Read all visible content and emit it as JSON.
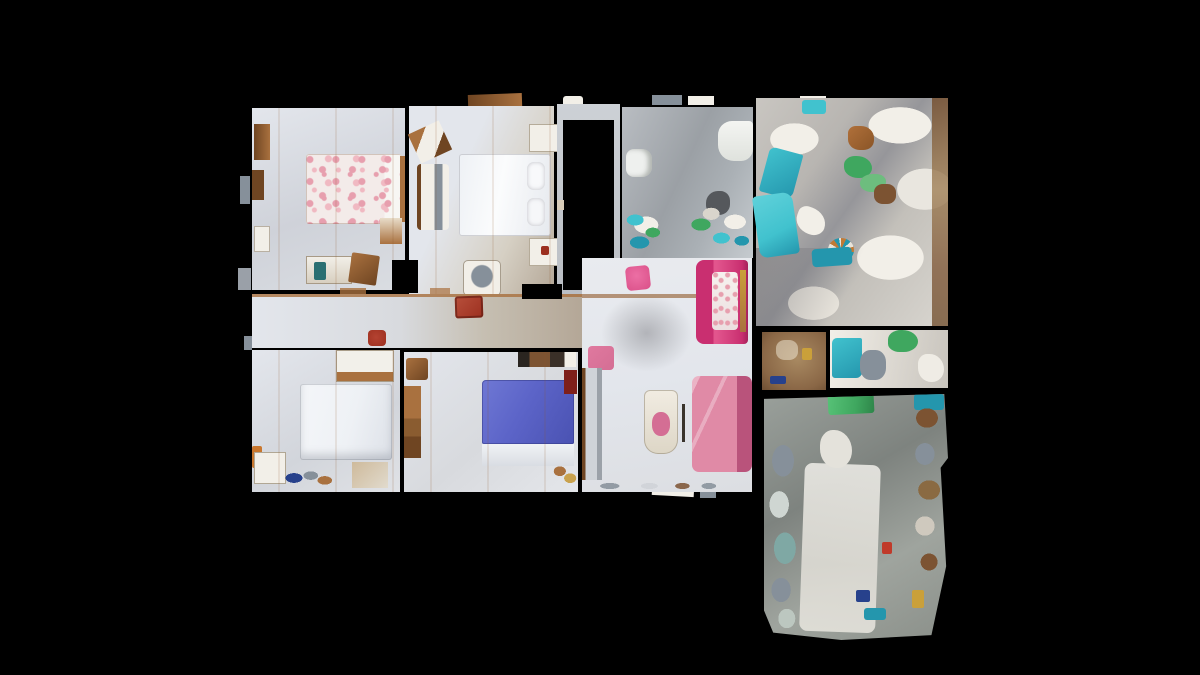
{
  "scene": {
    "type": "3d-scan-floorplan-topdown",
    "description": "Top-down dollhouse view of a 3D-scanned apartment floor plan centered on a black background",
    "background_color": "#000000",
    "visible_text": "",
    "rooms": [
      {
        "id": "bedroom-floral",
        "label": "Bedroom with floral double bed",
        "position": "top-left"
      },
      {
        "id": "bedroom-white",
        "label": "Bedroom with white double bed",
        "position": "top-center-left"
      },
      {
        "id": "stairwell",
        "label": "Stairwell void (black opening)",
        "position": "top-center"
      },
      {
        "id": "bathroom",
        "label": "Bathroom with tub and toilet",
        "position": "top-center-right"
      },
      {
        "id": "storage-top",
        "label": "Cluttered storage room with teal objects",
        "position": "top-right"
      },
      {
        "id": "hallway",
        "label": "Central hallway with red chair and stool",
        "position": "middle"
      },
      {
        "id": "living-room",
        "label": "Living room with magenta loveseat, pink sofa, ironing board",
        "position": "bottom-center-right"
      },
      {
        "id": "bedroom-single",
        "label": "Bedroom with white single bed",
        "position": "bottom-left"
      },
      {
        "id": "bedroom-blue",
        "label": "Bedroom with blue double bed and wardrobe",
        "position": "bottom-center"
      },
      {
        "id": "entry-closet",
        "label": "Small brown-floored entry closet",
        "position": "right-middle"
      },
      {
        "id": "storage-bottom",
        "label": "Cluttered storage room with green blanket",
        "position": "bottom-right"
      }
    ],
    "objects": [
      {
        "id": "floral-bed",
        "label": "Double bed with pink floral duvet"
      },
      {
        "id": "white-bed",
        "label": "White double bed with two pillows"
      },
      {
        "id": "single-bed",
        "label": "White single bed"
      },
      {
        "id": "blue-bed",
        "label": "Bed with periwinkle-blue duvet and white foot"
      },
      {
        "id": "magenta-loveseat",
        "label": "Magenta loveseat with floral cushions"
      },
      {
        "id": "pink-sofa",
        "label": "Rose-pink sofa"
      },
      {
        "id": "pink-ottoman",
        "label": "Pink ottoman"
      },
      {
        "id": "pink-stool",
        "label": "Small bright pink stool"
      },
      {
        "id": "red-chair",
        "label": "Dark red armchair in hallway"
      },
      {
        "id": "red-stool",
        "label": "Small dark red stool in hallway"
      },
      {
        "id": "ironing-board",
        "label": "Ironing board with pink garment"
      },
      {
        "id": "bathtub",
        "label": "White bathtub"
      },
      {
        "id": "toilet",
        "label": "White toilet"
      },
      {
        "id": "green-blanket",
        "label": "Green blanket in bottom storage room"
      },
      {
        "id": "stair-void",
        "label": "Black stairwell opening"
      }
    ],
    "palette": {
      "black": "#000000",
      "floor-light": "#e3e6ec",
      "floor-gray": "#9ba0a5",
      "floor-tan": "#b4a797",
      "floor-brown": "#8a6746",
      "storage-base": "#d9d6d0",
      "wood": "#a9713f",
      "wood-dark": "#6f4522",
      "bed-white": "#eef1f5",
      "bed-blue": "#5c64c8",
      "floral-pink": "#e79fae",
      "magenta": "#c92f70",
      "rose": "#d46e94",
      "pink-bright": "#da4f88",
      "red": "#9c2f1f",
      "dark-red": "#7e1f1a",
      "teal": "#41c2ce",
      "teal-dark": "#2496ad",
      "teal-gray": "#7fa8a4",
      "green": "#3fa75f",
      "slate": "#86909a",
      "cream": "#f2efe8",
      "brown": "#7c5332",
      "navy": "#27418c",
      "yellow": "#caa03a",
      "bin-teal": "#2a6f72"
    }
  }
}
